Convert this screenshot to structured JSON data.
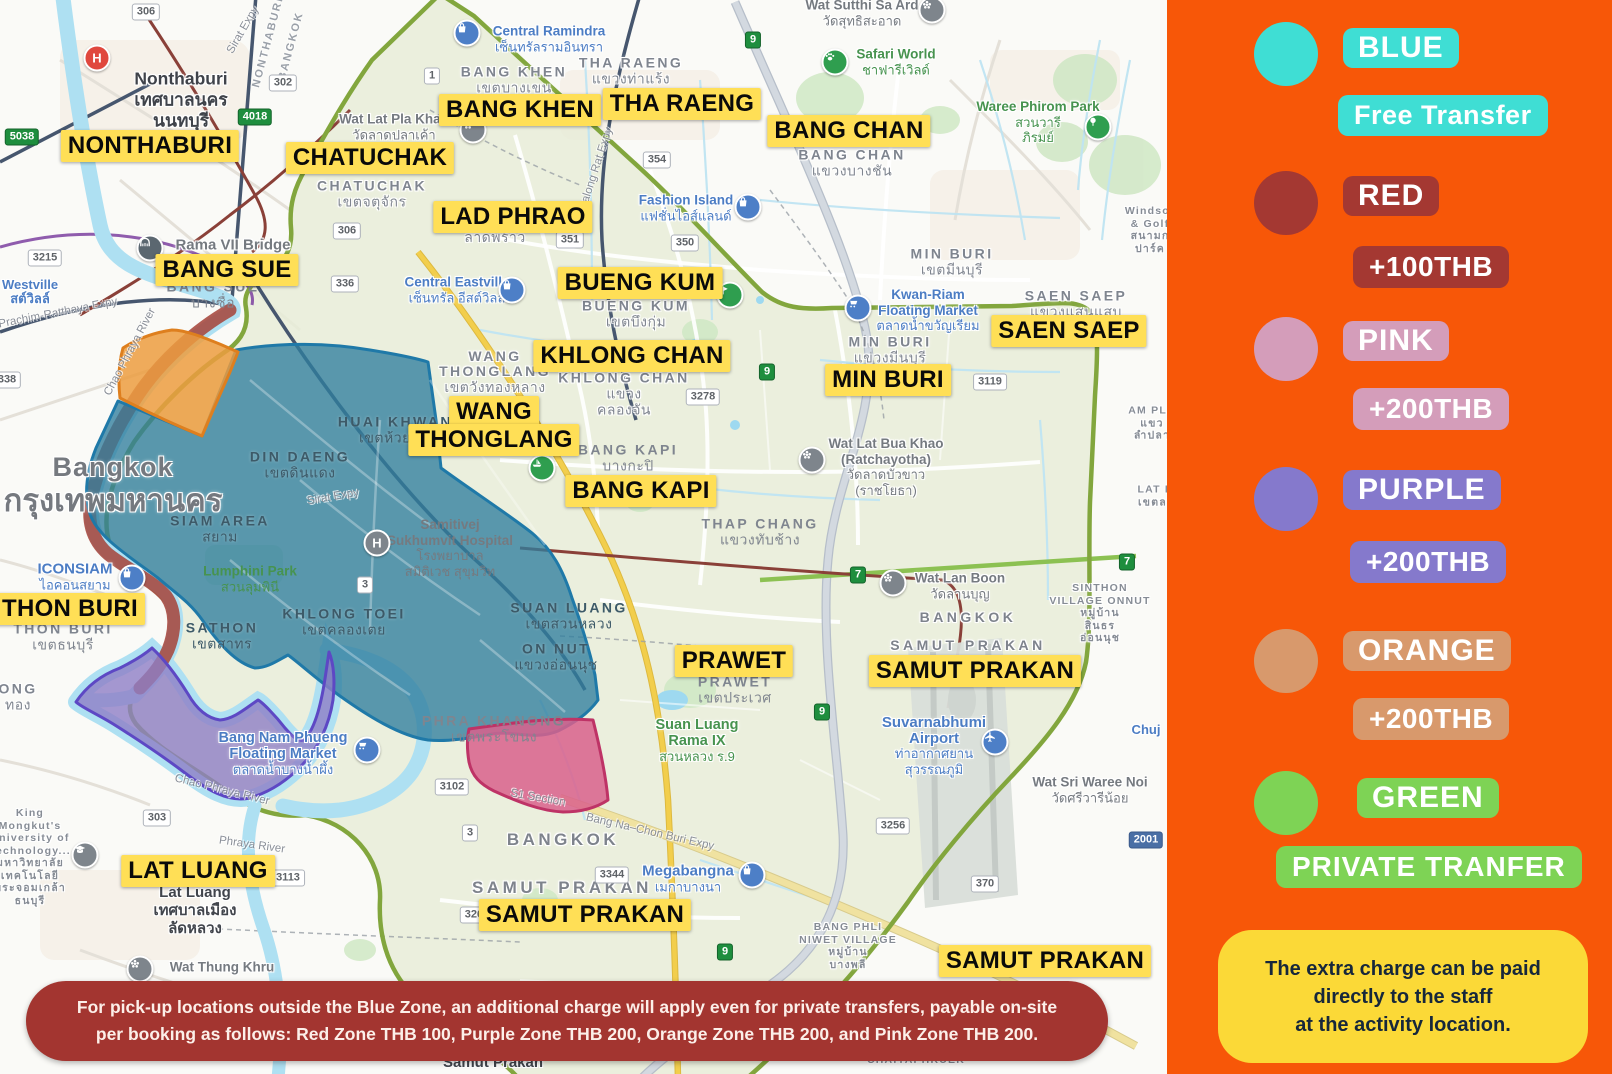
{
  "legend": {
    "items": [
      {
        "name": "BLUE",
        "fee": "Free Transfer",
        "color": "#3FDED4",
        "swatch_css": "background:#3FDED4",
        "badge_css": "background:#3FDED4",
        "fee_css": "background:#3FDED4;font-size:27px"
      },
      {
        "name": "RED",
        "fee": "+100THB",
        "color": "#A43832",
        "swatch_css": "background:#A43832",
        "badge_css": "background:#A43832",
        "fee_css": "background:#A43832"
      },
      {
        "name": "PINK",
        "fee": "+200THB",
        "color": "#D49DBA",
        "swatch_css": "background:#D49DBA",
        "badge_css": "background:#D49DBA",
        "fee_css": "background:#D49DBA"
      },
      {
        "name": "PURPLE",
        "fee": "+200THB",
        "color": "#8579CC",
        "swatch_css": "background:#8579CC",
        "badge_css": "background:#8579CC",
        "fee_css": "background:#8579CC"
      },
      {
        "name": "ORANGE",
        "fee": "+200THB",
        "color": "#D8996C",
        "swatch_css": "background:#D8996C",
        "badge_css": "background:#D8996C",
        "fee_css": "background:#D8996C"
      },
      {
        "name": "GREEN",
        "fee": "PRIVATE TRANFER",
        "color": "#7ED355",
        "swatch_css": "background:#7ED355",
        "badge_css": "background:#7ED355",
        "fee_css": "background:#7ED355;letter-spacing:1px"
      }
    ],
    "panel_color": "#F75708",
    "note": {
      "line1": "The extra charge can be paid",
      "line2": "directly to the staff",
      "line3": "at the activity location."
    }
  },
  "banner": {
    "line1": "For pick-up locations outside the Blue Zone, an additional charge will apply even for private transfers, payable on-site",
    "line2": "per booking as follows: Red Zone THB 100, Purple Zone THB 200, Orange Zone THB 200, and Pink Zone THB 200."
  },
  "map": {
    "zone_colors": {
      "blue": "#2F7E9E",
      "red": "#A6473E",
      "pink": "#D9608C",
      "purple": "#8F7EC5",
      "orange": "#EC9C40",
      "green_border": "#82A63D"
    },
    "hospital_letter": "H",
    "zone_labels": [
      {
        "t": "NONTHABURI",
        "x": 150,
        "y": 146
      },
      {
        "t": "CHATUCHAK",
        "x": 370,
        "y": 158
      },
      {
        "t": "BANG KHEN",
        "x": 520,
        "y": 110
      },
      {
        "t": "THA RAENG",
        "x": 682,
        "y": 104
      },
      {
        "t": "BANG CHAN",
        "x": 849,
        "y": 131
      },
      {
        "t": "LAD PHRAO",
        "x": 513,
        "y": 217
      },
      {
        "t": "BANG SUE",
        "x": 227,
        "y": 270
      },
      {
        "t": "BUENG KUM",
        "x": 640,
        "y": 283
      },
      {
        "t": "KHLONG CHAN",
        "x": 632,
        "y": 356
      },
      {
        "t": "SAEN SAEP",
        "x": 1069,
        "y": 331
      },
      {
        "t": "MIN BURI",
        "x": 888,
        "y": 380
      },
      {
        "t": "WANG",
        "x": 494,
        "y": 412
      },
      {
        "t": "THONGLANG",
        "x": 494,
        "y": 440
      },
      {
        "t": "BANG KAPI",
        "x": 641,
        "y": 491
      },
      {
        "t": "THON BURI",
        "x": 70,
        "y": 609
      },
      {
        "t": "PRAWET",
        "x": 734,
        "y": 661
      },
      {
        "t": "SAMUT PRAKAN",
        "x": 975,
        "y": 671
      },
      {
        "t": "LAT LUANG",
        "x": 198,
        "y": 871
      },
      {
        "t": "SAMUT PRAKAN",
        "x": 585,
        "y": 915
      },
      {
        "t": "SAMUT PRAKAN",
        "x": 1045,
        "y": 961
      }
    ],
    "districts": [
      {
        "en": "BANG KHEN",
        "th": "เขตบางเขน",
        "x": 514,
        "y": 80
      },
      {
        "en": "THA RAENG",
        "th": "แขวงท่าแร้ง",
        "x": 631,
        "y": 71
      },
      {
        "en": "CHATUCHAK",
        "th": "เขตจตุจักร",
        "x": 372,
        "y": 194
      },
      {
        "en": "BANG CHAN",
        "th": "แขวงบางชัน",
        "x": 852,
        "y": 163
      },
      {
        "en": "MIN BURI",
        "th": "เขตมีนบุรี",
        "x": 952,
        "y": 262
      },
      {
        "en": "MIN BURI",
        "th": "แขวงมีนบุรี",
        "x": 890,
        "y": 350
      },
      {
        "en": "SAEN SAEP",
        "th": "แขวงแสนแสบ",
        "x": 1076,
        "y": 304
      },
      {
        "en": "BUENG KUM",
        "th": "เขตบึงกุ่ม",
        "x": 636,
        "y": 314
      },
      {
        "en": "DIN DAENG",
        "th": "เขตดินแดง",
        "x": 300,
        "y": 465
      },
      {
        "en": "HUAI KHWANG",
        "th": "เขตห้วยขวาง",
        "x": 402,
        "y": 430
      },
      {
        "en": "SIAM AREA",
        "th": "สยาม",
        "x": 220,
        "y": 529
      },
      {
        "en": "SATHON",
        "th": "เขตสาทร",
        "x": 222,
        "y": 636
      },
      {
        "en": "KHLONG TOEI",
        "th": "เขตคลองเตย",
        "x": 344,
        "y": 622
      },
      {
        "en": "SUAN LUANG",
        "th": "เขตสวนหลวง",
        "x": 569,
        "y": 616
      },
      {
        "en": "ON NUT",
        "th": "แขวงอ่อนนุช",
        "x": 556,
        "y": 657
      },
      {
        "en": "PHRA KHANONG",
        "th": "เขตพระโขนง",
        "x": 494,
        "y": 729
      },
      {
        "en": "THON BURI",
        "th": "เขตธนบุรี",
        "x": 63,
        "y": 637
      },
      {
        "en": "THAP CHANG",
        "th": "แขวงทับช้าง",
        "x": 760,
        "y": 532
      },
      {
        "en": "PRAWET",
        "th": "เขตประเวศ",
        "x": 735,
        "y": 690
      },
      {
        "en": "BANG SUE",
        "th": "บางซื่อ",
        "x": 213,
        "y": 295
      },
      {
        "en": "BANG KAPI",
        "th": "บางกะปิ",
        "x": 628,
        "y": 458
      }
    ],
    "wang": {
      "l1": "WANG",
      "l2": "THONGLANG",
      "th": "เขตวังทองหลาง"
    },
    "khlongchan": {
      "l1": "KHLONG CHAN",
      "l2": "แขวง",
      "l3": "คลองจัน"
    },
    "ladphrao": {
      "th": "ลาดพร้าว"
    },
    "city": {
      "en": "Bangkok",
      "th": "กรุงเทพมหานคร"
    },
    "boundaries": [
      {
        "t": "BANGKOK",
        "x": 563,
        "y": 840
      },
      {
        "t": "SAMUT PRAKAN",
        "x": 562,
        "y": 888
      },
      {
        "t": "BANGKOK",
        "x": 968,
        "y": 617
      },
      {
        "t": "SAMUT PRAKAN",
        "x": 968,
        "y": 645
      }
    ],
    "towns": [
      {
        "l1": "Nonthaburi",
        "l2": "เทศบาลนคร",
        "l3": "นนทบุรี"
      },
      {
        "l1": "Lat Luang",
        "l2": "เทศบาลเมือง",
        "l3": "ลัดหลวง"
      },
      {
        "l1": "Samut Prakan"
      },
      {
        "l1": "SINTHON",
        "l2": "VILLAGE ONNUT",
        "l3": "หมู่บ้าน",
        "l4": "สินธร",
        "l5": "อ่อนนุช"
      },
      {
        "l1": "BANG PHLI",
        "l2": "NIWET VILLAGE",
        "l3": "หมู่บ้าน",
        "l4": "บางพลี"
      },
      {
        "l1": "CHAIYAPHRUEK"
      },
      {
        "l1": "AM PLA",
        "l2": "แขว",
        "l3": "ลำปลา"
      },
      {
        "l1": "LAT KR",
        "l2": "เขตลาด"
      },
      {
        "l1": "ONG",
        "l2": "ทอง"
      },
      {
        "l1": "Westville",
        "l2": "สต์วิลล์"
      },
      {
        "l1": "Chuj"
      },
      {
        "l1": "Windsor",
        "l2": "& Golf",
        "l3": "สนามก",
        "l4": "ปาร์ค"
      }
    ],
    "kmutt": {
      "l1": "King",
      "l2": "Mongkut's",
      "l3": "University of",
      "l4": "Technology...",
      "l5": "มหาวิทยาลัย",
      "l6": "เทคโนโลยี",
      "l7": "พระจอมเกล้า",
      "l8": "ธนบุรี"
    },
    "pois": [
      {
        "n1": "Central Ramindra",
        "t1": "เซ็นทรัลรามอินทรา"
      },
      {
        "n1": "Safari World",
        "t1": "ชาฟารีเวิลด์"
      },
      {
        "n1": "Wat Sutthi Sa Ard",
        "t1": "วัดสุทธิสะอาด"
      },
      {
        "n1": "Waree Phirom Park",
        "t1": "สวนวารี",
        "t2": "ภิรมย์"
      },
      {
        "n1": "Fashion Island",
        "t1": "แฟชั่นไอส์แลนด์"
      },
      {
        "n1": "Central Eastville",
        "t1": "เซ็นทรัล อีสต์วิลล์"
      },
      {
        "n1": "Wat Lat Pla Khao",
        "t1": "วัดลาดปลาเค้า"
      },
      {
        "n1": "Kwan-Riam",
        "n2": "Floating Market",
        "t1": "ตลาดน้ำขวัญเรียม"
      },
      {
        "n1": "Wat Lat Bua Khao",
        "n2": "(Ratchayotha)",
        "t1": "วัดลาดบัวขาว",
        "t2": "(ราชโยธา)"
      },
      {
        "n1": "Samitivej",
        "n2": "Sukhumvit Hospital",
        "t1": "โรงพยาบาล",
        "t2": "สมิติเวช สุขุมวิท"
      },
      {
        "n1": "ICONSIAM",
        "t1": "ไอคอนสยาม"
      },
      {
        "n1": "Lumphini Park",
        "t1": "สวนลุมพินี"
      },
      {
        "n1": "Wat Lan Boon",
        "t1": "วัดลานบุญ"
      },
      {
        "n1": "Suvarnabhumi",
        "n2": "Airport",
        "t1": "ท่าอากาศยาน",
        "t2": "สุวรรณภูมิ"
      },
      {
        "n1": "Megabangna",
        "t1": "เมกาบางนา"
      },
      {
        "n1": "Bang Nam Phueng",
        "n2": "Floating Market",
        "t1": "ตลาดน้ำบางน้ำผึ้ง"
      },
      {
        "n1": "Wat Thung Khru"
      },
      {
        "n1": "Suan Luang",
        "n2": "Rama IX",
        "t1": "สวนหลวง ร.9"
      },
      {
        "n1": "Rama VII Bridge"
      },
      {
        "n1": "Wat Sri Waree Noi",
        "t1": "วัดศรีวารีน้อย"
      }
    ],
    "routes": [
      {
        "n": "306"
      },
      {
        "n": "302"
      },
      {
        "n": "4018"
      },
      {
        "n": "5038"
      },
      {
        "n": "3215"
      },
      {
        "n": "306"
      },
      {
        "n": "336"
      },
      {
        "n": "1"
      },
      {
        "n": "351"
      },
      {
        "n": "350"
      },
      {
        "n": "354"
      },
      {
        "n": "9"
      },
      {
        "n": "9"
      },
      {
        "n": "9"
      },
      {
        "n": "9"
      },
      {
        "n": "7"
      },
      {
        "n": "7"
      },
      {
        "n": "3278"
      },
      {
        "n": "3119"
      },
      {
        "n": "3"
      },
      {
        "n": "3102"
      },
      {
        "n": "3"
      },
      {
        "n": "3344"
      },
      {
        "n": "3268"
      },
      {
        "n": "303"
      },
      {
        "n": "3113"
      },
      {
        "n": "3256"
      },
      {
        "n": "370"
      },
      {
        "n": "2001"
      },
      {
        "n": "338"
      }
    ],
    "road_labels": [
      {
        "t": "Chao Phraya River"
      },
      {
        "t": "Chao Phraya River"
      },
      {
        "t": "Phraya River"
      },
      {
        "t": "Sirat Expy"
      },
      {
        "t": "Sirat Expy"
      },
      {
        "t": "Chalong Rat Expy"
      },
      {
        "t": "Prachim-Ratthaya Expy"
      },
      {
        "t": "Bang Na–Chon Buri Expy"
      },
      {
        "t": "S1 Section"
      },
      {
        "t": "NONTHABURI"
      },
      {
        "t": "BANGKOK"
      }
    ]
  }
}
